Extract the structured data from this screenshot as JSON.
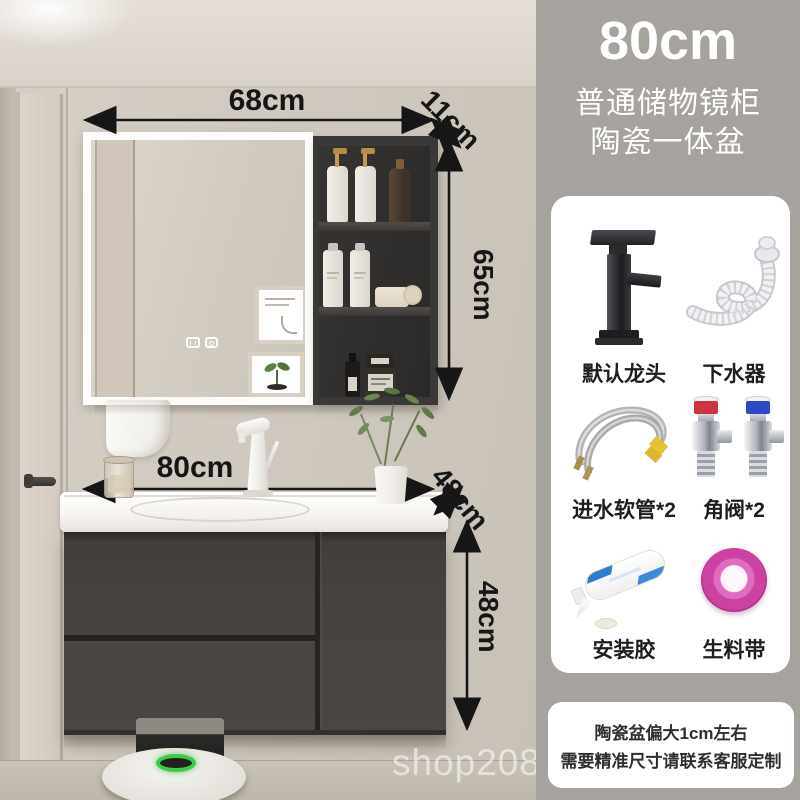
{
  "panel": {
    "title": "80cm",
    "subtitle_line1": "普通储物镜柜",
    "subtitle_line2": "陶瓷一体盆",
    "accessories": [
      {
        "label": "默认龙头"
      },
      {
        "label": "下水器"
      },
      {
        "label": "进水软管*2"
      },
      {
        "label": "角阀*2"
      },
      {
        "label": "安装胶"
      },
      {
        "label": "生料带"
      }
    ],
    "note": {
      "line1": "陶瓷盆偏大1cm左右",
      "line2": "需要精准尺寸请联系客服定制"
    }
  },
  "scene": {
    "dimensions": {
      "mirror_width": "68cm",
      "mirror_depth": "11cm",
      "mirror_height": "65cm",
      "vanity_width": "80cm",
      "vanity_depth": "48cm",
      "vanity_height": "48cm"
    },
    "watermark": "shop208925"
  },
  "colors": {
    "panel_bg": "#a6a29e",
    "cabinet_gray": "#45423f",
    "dimension_black": "#161616",
    "valve_red": "#cd3340",
    "valve_blue": "#2e46c8",
    "tape_pink": "#cb42a2",
    "robot_ring_green": "#3fcb4a",
    "plant_green": "#5f7a49"
  }
}
